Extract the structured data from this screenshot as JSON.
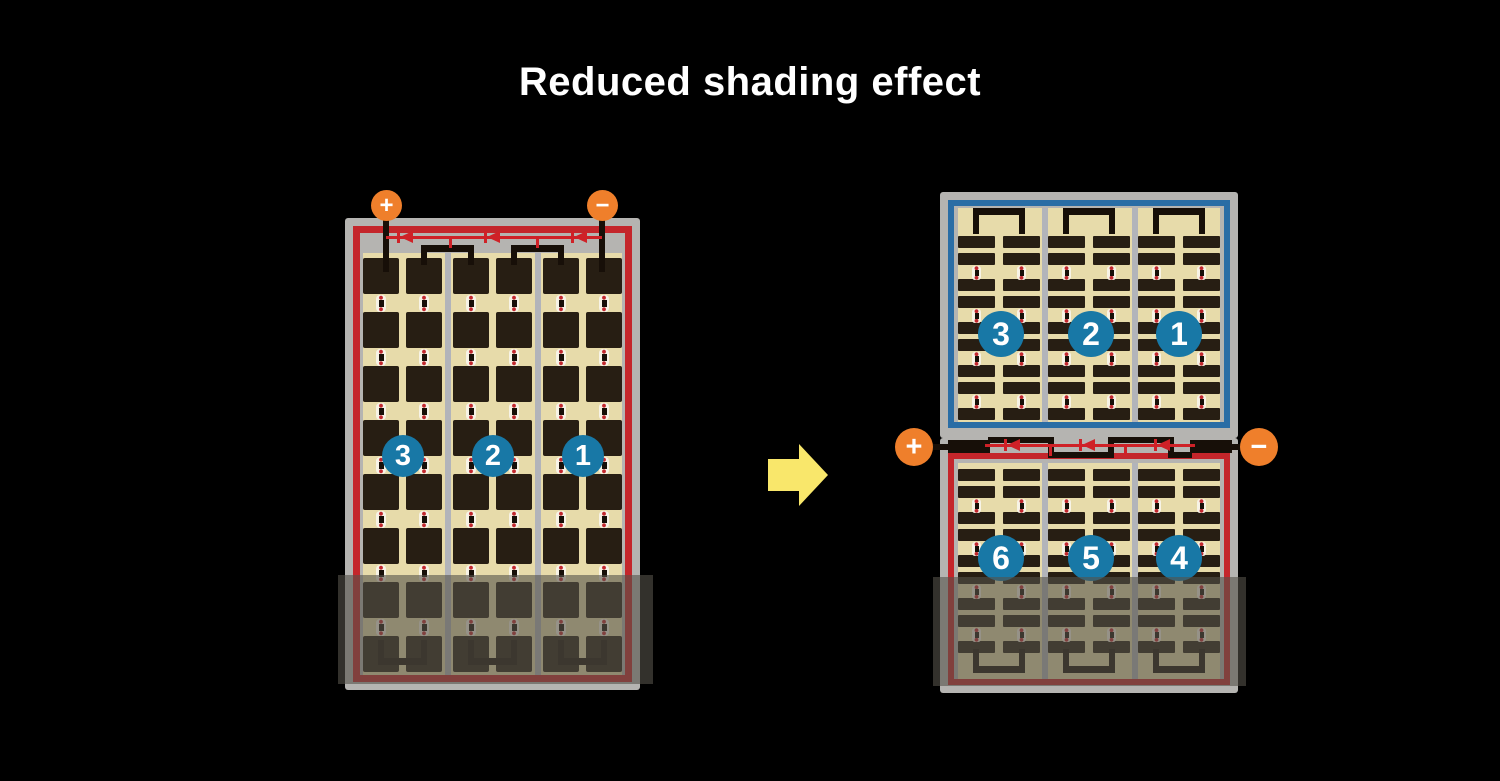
{
  "title": "Reduced shading effect",
  "left_panel": {
    "terminal_plus": "+",
    "terminal_minus": "−",
    "strings": [
      "3",
      "2",
      "1"
    ]
  },
  "right_assembly": {
    "top_strings": [
      "3",
      "2",
      "1"
    ],
    "bottom_strings": [
      "6",
      "5",
      "4"
    ],
    "terminal_plus": "+",
    "terminal_minus": "−"
  },
  "colors": {
    "background": "#000000",
    "titleWhite": "#ffffff",
    "frameGray": "#b5b4b1",
    "tan": "#e7dbaa",
    "cellDark": "#271e13",
    "divider": "#b2b4ba",
    "borderRed": "#c4262b",
    "borderBlue": "#2a6da5",
    "diodeRed": "#cf2127",
    "orange": "#ef7f2b",
    "circleBlue": "#1878a6",
    "connWhite": "#f7f3e6",
    "connRed": "#c1272d",
    "wireBlack": "#170f08",
    "shade": "rgba(85,82,74,0.6)",
    "arrowYellow": "#f9e76b"
  }
}
